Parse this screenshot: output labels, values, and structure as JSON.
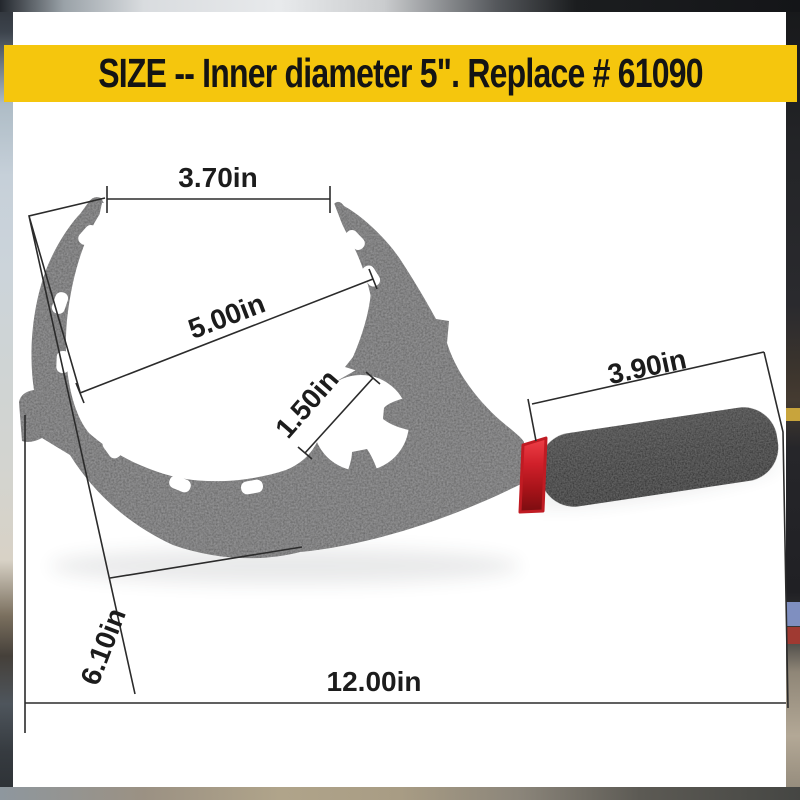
{
  "banner": {
    "text": "SIZE -- Inner diameter 5\". Replace # 61090",
    "bg_color": "#f5c60d",
    "text_color": "#141414"
  },
  "dimensions": {
    "jaw_opening": "3.70in",
    "inner_diameter": "5.00in",
    "small_opening": "1.50in",
    "handle_grip_length": "3.90in",
    "body_height": "6.10in",
    "overall_length": "12.00in"
  },
  "colors": {
    "tool_body": "#5e5e5e",
    "handle_grip_dark": "#1c1c1c",
    "handle_band_red": "#d2212a",
    "dimension_lines": "#2b2b2b",
    "banner_yellow": "#f5c60d"
  }
}
